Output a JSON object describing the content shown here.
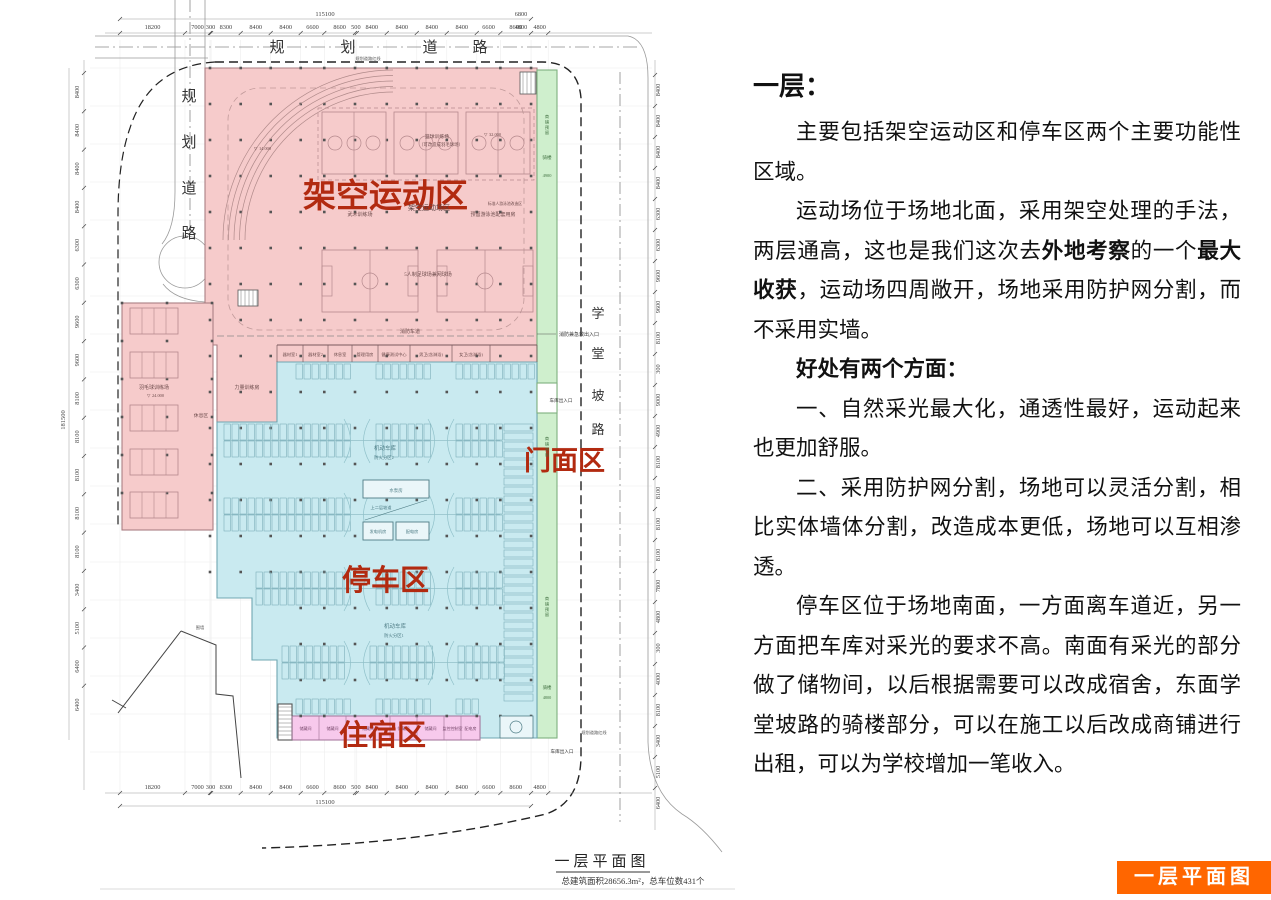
{
  "article": {
    "heading": "一层：",
    "paragraphs": [
      {
        "segments": [
          {
            "t": "主要包括架空运动区和停车区两个主要功能性区域。",
            "b": false
          }
        ]
      },
      {
        "segments": [
          {
            "t": "运动场位于场地北面，采用架空处理的手法，两层通高，这也是我们这次去",
            "b": false
          },
          {
            "t": "外地考察",
            "b": true
          },
          {
            "t": "的一个",
            "b": false
          },
          {
            "t": "最大收获",
            "b": true
          },
          {
            "t": "，运动场四周敞开，场地采用防护网分割，而不采用实墙。",
            "b": false
          }
        ]
      },
      {
        "segments": [
          {
            "t": "好处有两个方面：",
            "b": true
          }
        ]
      },
      {
        "segments": [
          {
            "t": "一、自然采光最大化，通透性最好，运动起来也更加舒服。",
            "b": false
          }
        ]
      },
      {
        "segments": [
          {
            "t": "二、采用防护网分割，场地可以灵活分割，相比实体墙体分割，改造成本更低，场地可以互相渗透。",
            "b": false
          }
        ]
      },
      {
        "segments": [
          {
            "t": "停车区位于场地南面，一方面离车道近，另一方面把车库对采光的要求不高。南面有采光的部分做了储物间，以后根据需要可以改成宿舍，东面学堂坡路的骑楼部分，可以在施工以后改成商铺进行出租，可以为学校增加一笔收入。",
            "b": false
          }
        ]
      }
    ]
  },
  "badge": {
    "label": "一层平面图",
    "color": "#FF6600"
  },
  "plan": {
    "caption": {
      "title": "一层平面图",
      "stats": "总建筑面积28656.3m²，总车位数431个"
    },
    "road_names": {
      "north": "规划道路",
      "west": "规划道路",
      "east": "学堂坡路"
    },
    "red_labels": {
      "sports": "架空运动区",
      "storefront": "门面区",
      "parking": "停车区",
      "dorm": "住宿区",
      "color": "#b22a10"
    },
    "zone_colors": {
      "sports": "#f6cbcb",
      "parking": "#c9eaf0",
      "storefront": "#cfefcd",
      "dorm": "#f7c9ec"
    },
    "small_labels": {
      "sports_deck": "架空运动场区",
      "wushu": "武术训练场",
      "basketball": "篮球训练场",
      "basketball_note": "（可改造成羽毛球场）",
      "pool_rooms": "预留游泳池配套用房",
      "pool_note": "标准人游泳池改造区",
      "football": "5人制足球场兼网球场",
      "badminton": "羽毛球训练场",
      "rest": "休息区",
      "strength": "力量训练房",
      "garage1": "机动车库",
      "fire_zone2": "防火分区2",
      "garage2": "机动车库",
      "fire_zone1": "防火分区1",
      "pump": "水泵房",
      "ramp": "上二层坡道",
      "generator": "发电机房",
      "power": "配电房",
      "fire_lane": "消防车道",
      "arcade_top": "骑楼",
      "arcade_top_dim": "4900",
      "arcade_bottom": "骑楼",
      "arcade_bottom_dim": "4800",
      "shop_reserve": "商铺预留",
      "fire_entrance": "消防兼急救出入口",
      "garage_entrance_east": "车库出入口",
      "garage_entrance_south": "车库出入口",
      "red_line": "规划道路红线",
      "fence": "围墙",
      "elev_24": "24.000",
      "elev_32": "32.000",
      "elev_14": "14.000"
    },
    "service_rooms": [
      "器材室1",
      "器材室2",
      "休息室",
      "管理用房",
      "健康测试中心",
      "男卫(含淋浴)",
      "女卫(含淋浴)"
    ],
    "dorm_rooms": [
      "储藏间",
      "储藏间",
      "储藏间",
      "储藏间",
      "储藏间",
      "监控控制室",
      "配电房"
    ],
    "dims": {
      "h_total": "115100",
      "h_row": [
        "18200",
        "7000",
        "300",
        "8300",
        "8400",
        "8400",
        "6600",
        "8600",
        "500",
        "8400",
        "8400",
        "8400",
        "8400",
        "6600",
        "8600",
        "4800"
      ],
      "corner_right": [
        "6800",
        "4800"
      ],
      "v_total": "181500",
      "left_col": [
        "8400",
        "8400",
        "8400",
        "8400",
        "6300",
        "6300",
        "9600",
        "9600",
        "8100",
        "8100",
        "8100",
        "8100",
        "8100",
        "3400",
        "5100",
        "6400",
        "6400"
      ],
      "right_col": [
        "8400",
        "8400",
        "8400",
        "8400",
        "6300",
        "6300",
        "9600",
        "9600",
        "8100",
        "300",
        "9000",
        "4900",
        "8100",
        "8100",
        "8100",
        "8100",
        "7800",
        "4800",
        "300",
        "4000",
        "8100",
        "3400",
        "5100",
        "6400"
      ]
    }
  }
}
